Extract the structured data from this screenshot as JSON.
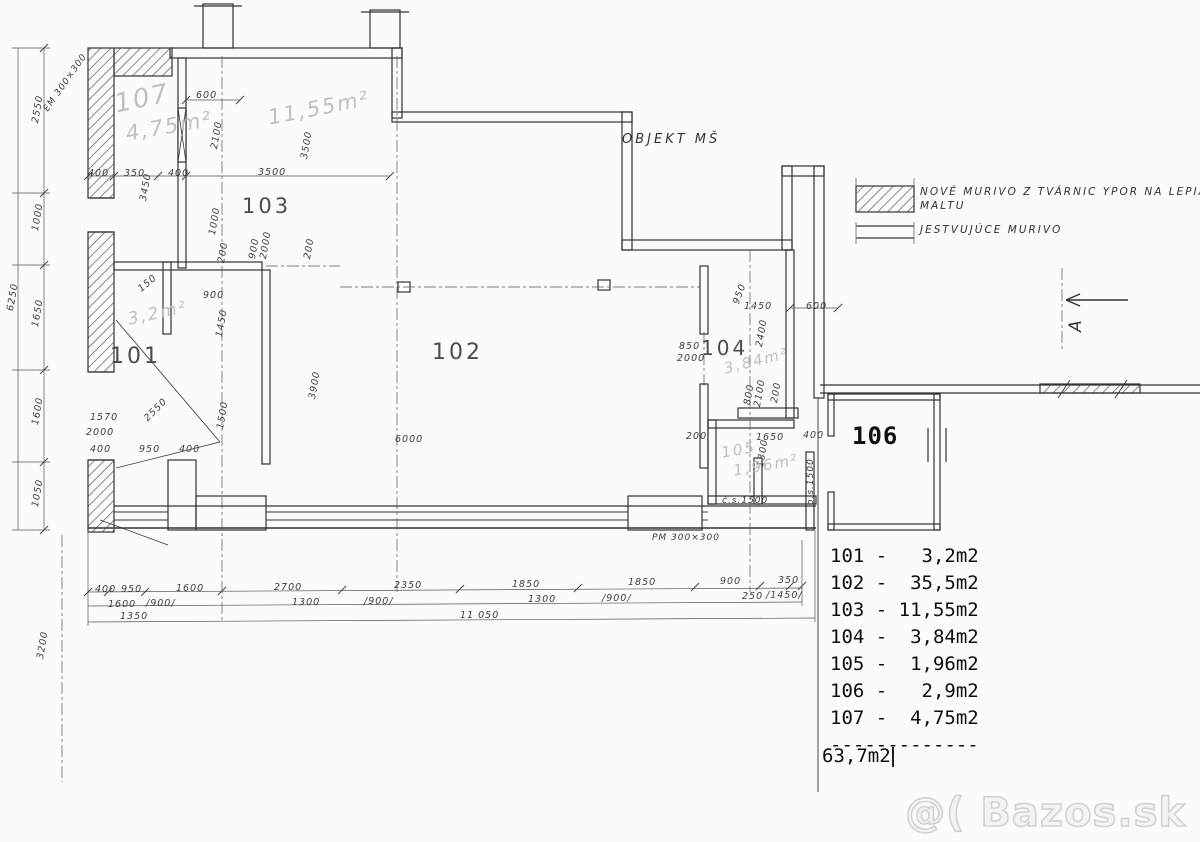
{
  "colors": {
    "ink": "#2f2f2f",
    "pencil": "#bcbcc2",
    "typed_overlay": "#0d0d0d",
    "watermark": "#d2d2d2",
    "paper": "#fbfbfa"
  },
  "title": {
    "text": "OBJEKT MŠ"
  },
  "legend": {
    "new_masonry_line1": "NOVÉ MURIVO Z TVÁRNIC YPOR NA LEPIACU",
    "new_masonry_line2": "MALTU",
    "existing_masonry": "JESTVUJÚCE MURIVO"
  },
  "section_marker": {
    "letter": "A"
  },
  "watermark": {
    "text": "@( Bazos.sk"
  },
  "area_list": {
    "lines": [
      "101 -   3,2m2",
      "102 -  35,5m2",
      "103 - 11,55m2",
      "104 -  3,84m2",
      "105 -  1,96m2",
      "106 -   2,9m2",
      "107 -  4,75m2",
      "-------------"
    ],
    "total": "63,7m2"
  },
  "room_labels": [
    {
      "t": "101",
      "x": 110,
      "y": 344,
      "s": 22,
      "n": "room-number-101"
    },
    {
      "t": "102",
      "x": 432,
      "y": 340,
      "s": 22,
      "n": "room-number-102"
    },
    {
      "t": "103",
      "x": 242,
      "y": 194,
      "s": 21,
      "n": "room-number-103"
    },
    {
      "t": "104",
      "x": 701,
      "y": 336,
      "s": 20,
      "n": "room-number-104"
    },
    {
      "t": "106",
      "x": 852,
      "y": 422,
      "s": 24,
      "mono": true,
      "n": "room-number-106"
    }
  ],
  "pencil_labels": [
    {
      "t": "107",
      "x": 112,
      "y": 90,
      "r": -12,
      "s": 26,
      "n": "pencil-room-107"
    },
    {
      "t": "4,75m²",
      "x": 124,
      "y": 122,
      "r": -10,
      "s": 21,
      "n": "pencil-area-107"
    },
    {
      "t": "11,55m²",
      "x": 266,
      "y": 106,
      "r": -11,
      "s": 21,
      "n": "pencil-area-103"
    },
    {
      "t": "3,2m²",
      "x": 126,
      "y": 310,
      "r": -12,
      "s": 17,
      "n": "pencil-area-101"
    },
    {
      "t": "3,84m²",
      "x": 722,
      "y": 360,
      "r": -14,
      "s": 15,
      "n": "pencil-area-104"
    },
    {
      "t": "105",
      "x": 720,
      "y": 444,
      "r": -10,
      "s": 15,
      "n": "pencil-room-105"
    },
    {
      "t": "1,96m²",
      "x": 732,
      "y": 462,
      "r": -10,
      "s": 15,
      "n": "pencil-area-105"
    }
  ],
  "annotations": [
    {
      "t": "EM 300×300",
      "x": 42,
      "y": 108,
      "r": -55,
      "n": "note-em-300x300"
    },
    {
      "t": "PM 300×300",
      "x": 652,
      "y": 533,
      "r": 0,
      "n": "note-pm-300x300"
    },
    {
      "t": "č.s.1500",
      "x": 722,
      "y": 496,
      "r": 0,
      "n": "note-cs-1500"
    },
    {
      "t": "o.s.1500",
      "x": 806,
      "y": 505,
      "r": -90,
      "n": "note-os-1500"
    }
  ],
  "dimensions": [
    {
      "t": "2550",
      "x": 30,
      "y": 122,
      "r": -80
    },
    {
      "t": "1000",
      "x": 30,
      "y": 230,
      "r": -80
    },
    {
      "t": "1650",
      "x": 30,
      "y": 326,
      "r": -80
    },
    {
      "t": "1600",
      "x": 30,
      "y": 424,
      "r": -80
    },
    {
      "t": "1050",
      "x": 30,
      "y": 506,
      "r": -80
    },
    {
      "t": "6250",
      "x": 5,
      "y": 310,
      "r": -80
    },
    {
      "t": "3200",
      "x": 35,
      "y": 658,
      "r": -80
    },
    {
      "t": "400",
      "x": 88,
      "y": 168,
      "r": 0
    },
    {
      "t": "350",
      "x": 124,
      "y": 168,
      "r": 0
    },
    {
      "t": "400",
      "x": 168,
      "y": 168,
      "r": 0
    },
    {
      "t": "600",
      "x": 196,
      "y": 90,
      "r": 0
    },
    {
      "t": "2100",
      "x": 209,
      "y": 148,
      "r": -80
    },
    {
      "t": "3500",
      "x": 258,
      "y": 167,
      "r": 0
    },
    {
      "t": "3500",
      "x": 299,
      "y": 158,
      "r": -80
    },
    {
      "t": "3450",
      "x": 138,
      "y": 200,
      "r": -80
    },
    {
      "t": "1000",
      "x": 207,
      "y": 234,
      "r": -80
    },
    {
      "t": "200",
      "x": 216,
      "y": 262,
      "r": -80
    },
    {
      "t": "900",
      "x": 247,
      "y": 258,
      "r": -80
    },
    {
      "t": "2000",
      "x": 258,
      "y": 258,
      "r": -80
    },
    {
      "t": "200",
      "x": 302,
      "y": 258,
      "r": -80
    },
    {
      "t": "900",
      "x": 203,
      "y": 290,
      "r": 0
    },
    {
      "t": "150",
      "x": 136,
      "y": 286,
      "r": -40
    },
    {
      "t": "1450",
      "x": 214,
      "y": 336,
      "r": -80
    },
    {
      "t": "1500",
      "x": 215,
      "y": 428,
      "r": -80
    },
    {
      "t": "2550",
      "x": 142,
      "y": 416,
      "r": -45
    },
    {
      "t": "1570",
      "x": 90,
      "y": 412,
      "r": 0
    },
    {
      "t": "2000",
      "x": 86,
      "y": 427,
      "r": 0
    },
    {
      "t": "400",
      "x": 90,
      "y": 444,
      "r": 0
    },
    {
      "t": "950",
      "x": 139,
      "y": 444,
      "r": 0
    },
    {
      "t": "400",
      "x": 179,
      "y": 444,
      "r": 0
    },
    {
      "t": "3900",
      "x": 307,
      "y": 398,
      "r": -80
    },
    {
      "t": "6000",
      "x": 395,
      "y": 434,
      "r": 0
    },
    {
      "t": "200",
      "x": 686,
      "y": 431,
      "r": 0
    },
    {
      "t": "850",
      "x": 679,
      "y": 341,
      "r": 0
    },
    {
      "t": "2000",
      "x": 677,
      "y": 353,
      "r": 0
    },
    {
      "t": "950",
      "x": 731,
      "y": 302,
      "r": -70
    },
    {
      "t": "1450",
      "x": 744,
      "y": 301,
      "r": 0
    },
    {
      "t": "600",
      "x": 806,
      "y": 301,
      "r": 0
    },
    {
      "t": "2400",
      "x": 754,
      "y": 346,
      "r": -80
    },
    {
      "t": "2100",
      "x": 752,
      "y": 406,
      "r": -80
    },
    {
      "t": "800",
      "x": 742,
      "y": 404,
      "r": -80
    },
    {
      "t": "200",
      "x": 769,
      "y": 402,
      "r": -80
    },
    {
      "t": "1650",
      "x": 756,
      "y": 432,
      "r": 0
    },
    {
      "t": "400",
      "x": 803,
      "y": 430,
      "r": 0
    },
    {
      "t": "1300",
      "x": 755,
      "y": 466,
      "r": -80
    },
    {
      "t": "400",
      "x": 95,
      "y": 584,
      "r": 0
    },
    {
      "t": "950",
      "x": 121,
      "y": 584,
      "r": 0
    },
    {
      "t": "1600",
      "x": 176,
      "y": 583,
      "r": 0
    },
    {
      "t": "2700",
      "x": 274,
      "y": 582,
      "r": 0
    },
    {
      "t": "2350",
      "x": 394,
      "y": 580,
      "r": 0
    },
    {
      "t": "1850",
      "x": 512,
      "y": 579,
      "r": 0
    },
    {
      "t": "1850",
      "x": 628,
      "y": 577,
      "r": 0
    },
    {
      "t": "900",
      "x": 720,
      "y": 576,
      "r": 0
    },
    {
      "t": "350",
      "x": 778,
      "y": 575,
      "r": 0
    },
    {
      "t": "1600",
      "x": 108,
      "y": 599,
      "r": 0
    },
    {
      "t": "/900/",
      "x": 146,
      "y": 598,
      "r": 0
    },
    {
      "t": "1350",
      "x": 120,
      "y": 611,
      "r": 0
    },
    {
      "t": "1300",
      "x": 292,
      "y": 597,
      "r": 0
    },
    {
      "t": "/900/",
      "x": 364,
      "y": 596,
      "r": 0
    },
    {
      "t": "1300",
      "x": 528,
      "y": 594,
      "r": 0
    },
    {
      "t": "/900/",
      "x": 602,
      "y": 593,
      "r": 0
    },
    {
      "t": "250",
      "x": 742,
      "y": 591,
      "r": 0
    },
    {
      "t": "/1450/",
      "x": 766,
      "y": 590,
      "r": 0
    },
    {
      "t": "11 050",
      "x": 460,
      "y": 610,
      "r": 0
    }
  ]
}
